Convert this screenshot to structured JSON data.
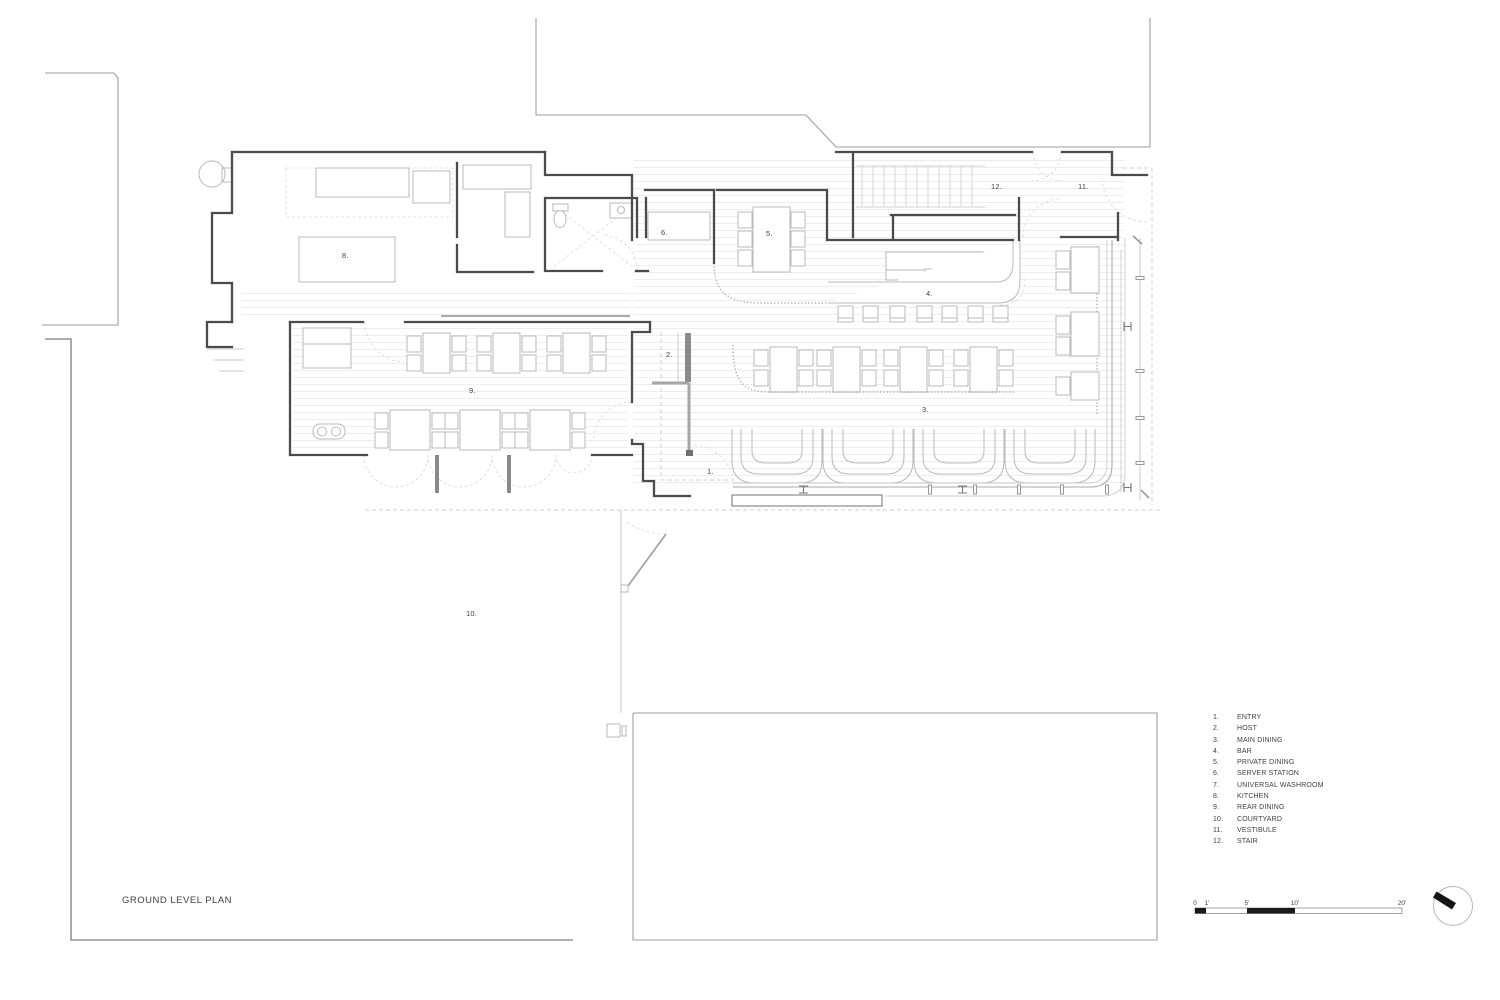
{
  "title": "GROUND LEVEL PLAN",
  "legend": {
    "items": [
      {
        "num": "1.",
        "label": "ENTRY"
      },
      {
        "num": "2.",
        "label": "HOST"
      },
      {
        "num": "3.",
        "label": "MAIN DINING"
      },
      {
        "num": "4.",
        "label": "BAR"
      },
      {
        "num": "5.",
        "label": "PRIVATE DINING"
      },
      {
        "num": "6.",
        "label": "SERVER STATION"
      },
      {
        "num": "7.",
        "label": "UNIVERSAL WASHROOM"
      },
      {
        "num": "8.",
        "label": "KITCHEN"
      },
      {
        "num": "9.",
        "label": "REAR DINING"
      },
      {
        "num": "10.",
        "label": "COURTYARD"
      },
      {
        "num": "11.",
        "label": "VESTIBULE"
      },
      {
        "num": "12.",
        "label": "STAIR"
      }
    ]
  },
  "plan": {
    "room_labels": [
      {
        "id": "entry",
        "text": "1.",
        "x": 707,
        "y": 474
      },
      {
        "id": "host",
        "text": "2.",
        "x": 666,
        "y": 357
      },
      {
        "id": "main-dining",
        "text": "3.",
        "x": 922,
        "y": 412
      },
      {
        "id": "bar",
        "text": "4.",
        "x": 926,
        "y": 296
      },
      {
        "id": "private-dining",
        "text": "5.",
        "x": 766,
        "y": 236
      },
      {
        "id": "server-station",
        "text": "6.",
        "x": 661,
        "y": 235
      },
      {
        "id": "kitchen",
        "text": "8.",
        "x": 342,
        "y": 258
      },
      {
        "id": "rear-dining",
        "text": "9.",
        "x": 469,
        "y": 393
      },
      {
        "id": "courtyard",
        "text": "10.",
        "x": 466,
        "y": 616
      },
      {
        "id": "vestibule",
        "text": "11.",
        "x": 1078,
        "y": 189
      },
      {
        "id": "stair",
        "text": "12.",
        "x": 991,
        "y": 189
      }
    ]
  },
  "scale_bar": {
    "unit_labels": [
      {
        "label": "0",
        "x": 1195
      },
      {
        "label": "1'",
        "x": 1207
      },
      {
        "label": "5'",
        "x": 1247
      },
      {
        "label": "10'",
        "x": 1295
      },
      {
        "label": "20'",
        "x": 1402
      }
    ]
  },
  "north_arrow": {
    "style": "circle-with-needle",
    "points": "northwest"
  },
  "colors": {
    "wall": "#4b4b4b",
    "furniture_line": "#b9b9b9",
    "dashed_line": "#cfcfcf",
    "neighbor_line": "#9e9e9e",
    "floor_stripe": "#ededed",
    "text": "#3f3f3f",
    "scale_fill": "#1a1a1a"
  }
}
